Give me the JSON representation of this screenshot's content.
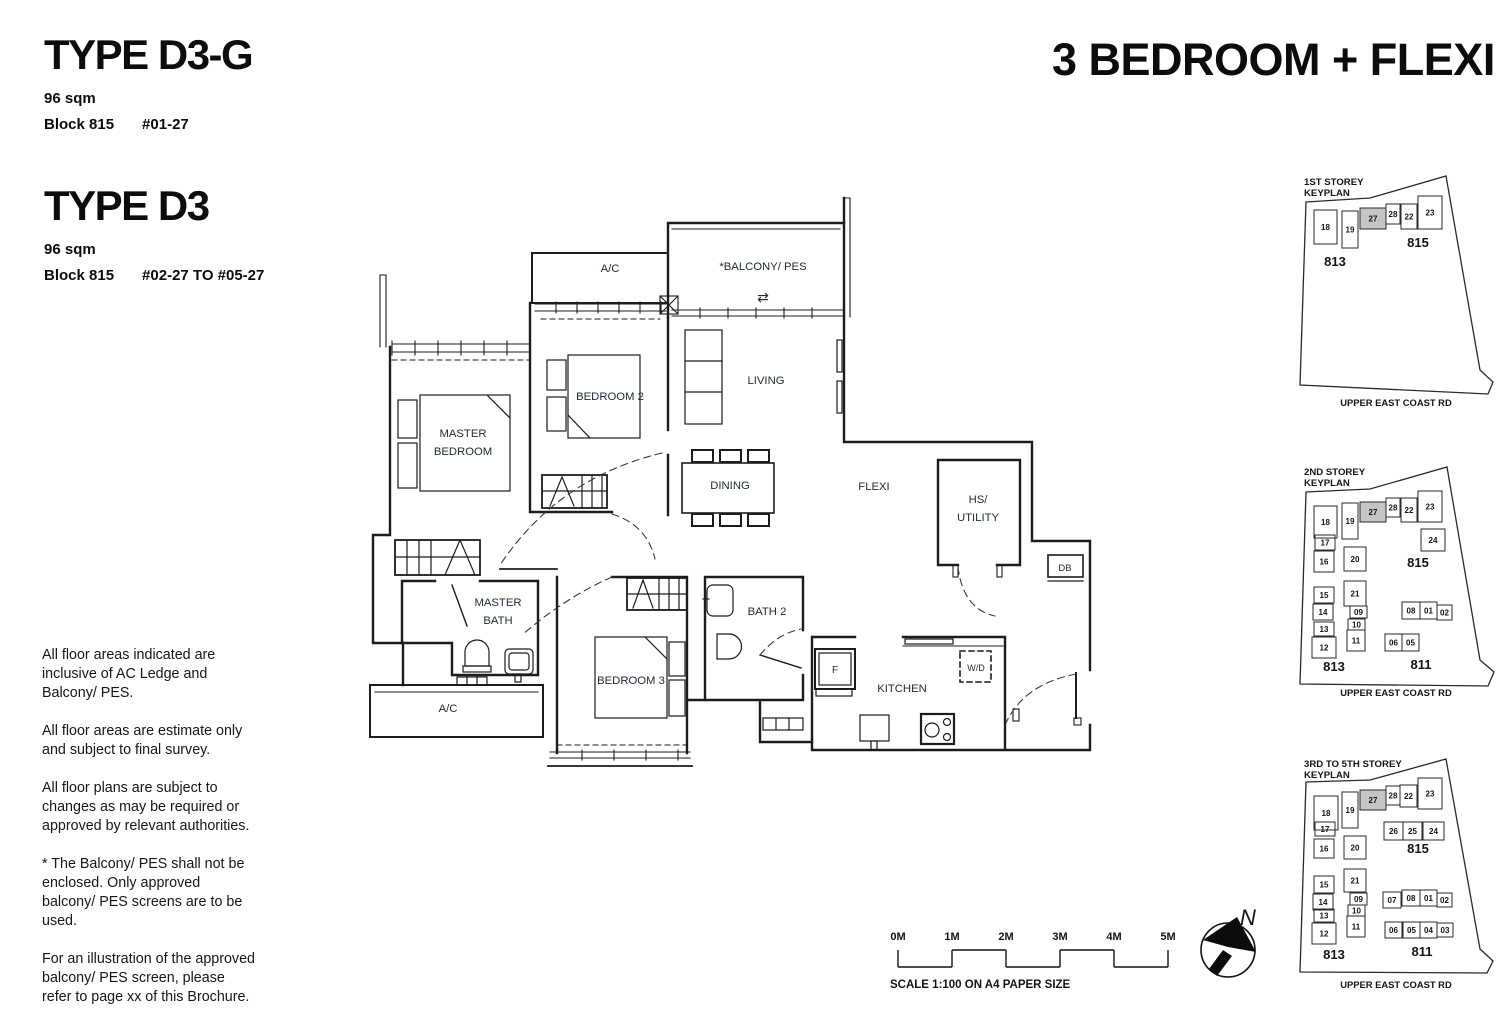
{
  "header": {
    "unit_types": [
      {
        "name": "TYPE D3-G",
        "area": "96 sqm",
        "block": "Block 815",
        "stack": "#01-27"
      },
      {
        "name": "TYPE D3",
        "area": "96 sqm",
        "block": "Block 815",
        "stack": "#02-27 TO #05-27"
      }
    ],
    "category": "3 BEDROOM + FLEXI"
  },
  "notes": [
    "All floor areas indicated are inclusive of AC Ledge and Balcony/ PES.",
    "All floor areas are estimate only and subject to final survey.",
    "All floor plans are subject to changes as may be required or approved by relevant authorities.",
    "* The Balcony/ PES shall not be enclosed. Only approved balcony/ PES screens are to be used.",
    "For an illustration of the approved balcony/ PES screen, please refer to page xx of this Brochure."
  ],
  "floorplan": {
    "labels": {
      "ac_top": "A/C",
      "balcony": "*BALCONY/ PES",
      "balcony_arrows": "⇄",
      "bedroom2": "BEDROOM 2",
      "living": "LIVING",
      "master_1": "MASTER",
      "master_2": "BEDROOM",
      "dining": "DINING",
      "flexi": "FLEXI",
      "hs_1": "HS/",
      "hs_2": "UTILITY",
      "db": "DB",
      "mbath_1": "MASTER",
      "mbath_2": "BATH",
      "bath2": "BATH 2",
      "bedroom3": "BEDROOM 3",
      "ac_bottom": "A/C",
      "fridge": "F",
      "kitchen": "KITCHEN",
      "wd": "W/D"
    }
  },
  "scalebar": {
    "ticks": [
      "0M",
      "1M",
      "2M",
      "3M",
      "4M",
      "5M"
    ],
    "caption": "SCALE  1:100 ON A4 PAPER SIZE"
  },
  "compass": {
    "label": "N"
  },
  "keyplans": [
    {
      "title_lines": [
        "1ST STOREY",
        "KEYPLAN"
      ],
      "title_y": 19,
      "road_y": 240,
      "road": "UPPER EAST COAST RD",
      "boundary": "16,36 80,32 156,10 190,204 203,216 198,228 10,219",
      "blocks": [
        {
          "t": "813",
          "x": 45,
          "y": 100
        },
        {
          "t": "815",
          "x": 128,
          "y": 81
        }
      ],
      "units": [
        {
          "n": "18",
          "x": 24,
          "y": 44,
          "w": 23,
          "h": 34
        },
        {
          "n": "19",
          "x": 52,
          "y": 45,
          "w": 16,
          "h": 37
        },
        {
          "n": "27",
          "x": 70,
          "y": 42,
          "w": 26,
          "h": 21,
          "hl": true
        },
        {
          "n": "28",
          "x": 96,
          "y": 38,
          "w": 14,
          "h": 20
        },
        {
          "n": "22",
          "x": 111,
          "y": 38,
          "w": 16,
          "h": 25
        },
        {
          "n": "23",
          "x": 128,
          "y": 30,
          "w": 24,
          "h": 33
        }
      ]
    },
    {
      "title_lines": [
        "2ND STOREY",
        "KEYPLAN"
      ],
      "title_y": 19,
      "road_y": 240,
      "road": "UPPER EAST COAST RD",
      "boundary": "16,36 80,33 157,11 190,204 204,216 198,230 10,228",
      "blocks": [
        {
          "t": "813",
          "x": 44,
          "y": 215
        },
        {
          "t": "811",
          "x": 131,
          "y": 213
        },
        {
          "t": "815",
          "x": 128,
          "y": 111
        }
      ],
      "units": [
        {
          "n": "18",
          "x": 24,
          "y": 50,
          "w": 23,
          "h": 32
        },
        {
          "n": "19",
          "x": 52,
          "y": 47,
          "w": 16,
          "h": 36
        },
        {
          "n": "27",
          "x": 70,
          "y": 46,
          "w": 26,
          "h": 20,
          "hl": true
        },
        {
          "n": "28",
          "x": 96,
          "y": 42,
          "w": 14,
          "h": 19
        },
        {
          "n": "22",
          "x": 111,
          "y": 42,
          "w": 16,
          "h": 24
        },
        {
          "n": "23",
          "x": 128,
          "y": 35,
          "w": 24,
          "h": 31
        },
        {
          "n": "24",
          "x": 131,
          "y": 73,
          "w": 24,
          "h": 22
        },
        {
          "n": "17",
          "x": 25,
          "y": 79,
          "w": 20,
          "h": 15
        },
        {
          "n": "16",
          "x": 24,
          "y": 95,
          "w": 20,
          "h": 21
        },
        {
          "n": "20",
          "x": 54,
          "y": 91,
          "w": 22,
          "h": 24
        },
        {
          "n": "15",
          "x": 24,
          "y": 131,
          "w": 20,
          "h": 16
        },
        {
          "n": "21",
          "x": 54,
          "y": 125,
          "w": 22,
          "h": 25
        },
        {
          "n": "14",
          "x": 23,
          "y": 148,
          "w": 20,
          "h": 16
        },
        {
          "n": "09",
          "x": 60,
          "y": 150,
          "w": 17,
          "h": 12
        },
        {
          "n": "10",
          "x": 58,
          "y": 163,
          "w": 17,
          "h": 11
        },
        {
          "n": "13",
          "x": 24,
          "y": 166,
          "w": 20,
          "h": 14
        },
        {
          "n": "12",
          "x": 22,
          "y": 181,
          "w": 24,
          "h": 21
        },
        {
          "n": "11",
          "x": 57,
          "y": 174,
          "w": 18,
          "h": 21
        },
        {
          "n": "08",
          "x": 112,
          "y": 146,
          "w": 18,
          "h": 17
        },
        {
          "n": "01",
          "x": 130,
          "y": 146,
          "w": 17,
          "h": 17
        },
        {
          "n": "02",
          "x": 147,
          "y": 149,
          "w": 15,
          "h": 15
        },
        {
          "n": "06",
          "x": 95,
          "y": 178,
          "w": 17,
          "h": 17
        },
        {
          "n": "05",
          "x": 112,
          "y": 178,
          "w": 17,
          "h": 17
        }
      ]
    },
    {
      "title_lines": [
        "3RD TO 5TH STOREY",
        "KEYPLAN"
      ],
      "title_y": 15,
      "road_y": 236,
      "road": "UPPER EAST COAST RD",
      "boundary": "16,30 80,28 156,7 190,197 203,209 197,221 10,220",
      "blocks": [
        {
          "t": "813",
          "x": 44,
          "y": 207
        },
        {
          "t": "811",
          "x": 132,
          "y": 204
        },
        {
          "t": "815",
          "x": 128,
          "y": 101
        }
      ],
      "units": [
        {
          "n": "18",
          "x": 24,
          "y": 44,
          "w": 24,
          "h": 34
        },
        {
          "n": "19",
          "x": 52,
          "y": 40,
          "w": 16,
          "h": 36
        },
        {
          "n": "27",
          "x": 70,
          "y": 38,
          "w": 26,
          "h": 20,
          "hl": true
        },
        {
          "n": "28",
          "x": 96,
          "y": 34,
          "w": 14,
          "h": 19
        },
        {
          "n": "22",
          "x": 110,
          "y": 33,
          "w": 17,
          "h": 22
        },
        {
          "n": "23",
          "x": 128,
          "y": 26,
          "w": 24,
          "h": 31
        },
        {
          "n": "17",
          "x": 25,
          "y": 70,
          "w": 20,
          "h": 14
        },
        {
          "n": "26",
          "x": 94,
          "y": 70,
          "w": 19,
          "h": 18
        },
        {
          "n": "25",
          "x": 113,
          "y": 70,
          "w": 19,
          "h": 18
        },
        {
          "n": "24",
          "x": 133,
          "y": 70,
          "w": 21,
          "h": 18
        },
        {
          "n": "16",
          "x": 24,
          "y": 87,
          "w": 20,
          "h": 19
        },
        {
          "n": "20",
          "x": 54,
          "y": 84,
          "w": 22,
          "h": 23
        },
        {
          "n": "15",
          "x": 24,
          "y": 124,
          "w": 20,
          "h": 17
        },
        {
          "n": "21",
          "x": 54,
          "y": 117,
          "w": 22,
          "h": 23
        },
        {
          "n": "14",
          "x": 23,
          "y": 142,
          "w": 20,
          "h": 16
        },
        {
          "n": "09",
          "x": 60,
          "y": 141,
          "w": 17,
          "h": 12
        },
        {
          "n": "10",
          "x": 58,
          "y": 153,
          "w": 17,
          "h": 11
        },
        {
          "n": "13",
          "x": 24,
          "y": 157,
          "w": 20,
          "h": 13
        },
        {
          "n": "12",
          "x": 22,
          "y": 171,
          "w": 24,
          "h": 21
        },
        {
          "n": "11",
          "x": 57,
          "y": 164,
          "w": 18,
          "h": 21
        },
        {
          "n": "07",
          "x": 93,
          "y": 140,
          "w": 18,
          "h": 16
        },
        {
          "n": "08",
          "x": 112,
          "y": 138,
          "w": 18,
          "h": 16
        },
        {
          "n": "01",
          "x": 130,
          "y": 138,
          "w": 17,
          "h": 16
        },
        {
          "n": "02",
          "x": 147,
          "y": 141,
          "w": 15,
          "h": 14
        },
        {
          "n": "06",
          "x": 95,
          "y": 170,
          "w": 17,
          "h": 16
        },
        {
          "n": "05",
          "x": 113,
          "y": 170,
          "w": 17,
          "h": 16
        },
        {
          "n": "04",
          "x": 130,
          "y": 170,
          "w": 17,
          "h": 16
        },
        {
          "n": "03",
          "x": 147,
          "y": 171,
          "w": 16,
          "h": 14
        }
      ]
    }
  ]
}
